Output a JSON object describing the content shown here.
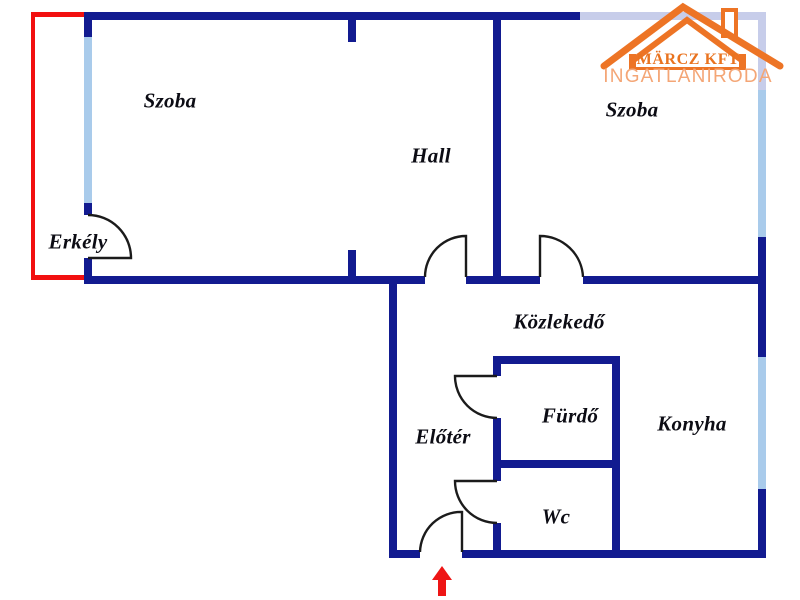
{
  "logo": {
    "company": "MÄRCZ KFT",
    "subtitle": "INGATLANIRODA"
  },
  "rooms": {
    "szoba_left": "Szoba",
    "hall": "Hall",
    "szoba_right": "Szoba",
    "erkely": "Erkély",
    "kozlekedo": "Közlekedő",
    "eloter": "Előtér",
    "furdo": "Fürdő",
    "wc": "Wc",
    "konyha": "Konyha"
  },
  "colors": {
    "wall": "#121b90",
    "window": "#a9cbeb",
    "window_top": "#c7cdea",
    "balcony": "#f21010",
    "door": "#1b1b1b",
    "arrow": "#ee1515",
    "label": "#0c0c14",
    "logo_orange": "#ed7425",
    "logo_company_text": "#e9731f",
    "logo_subtitle_text": "#f4a676"
  }
}
